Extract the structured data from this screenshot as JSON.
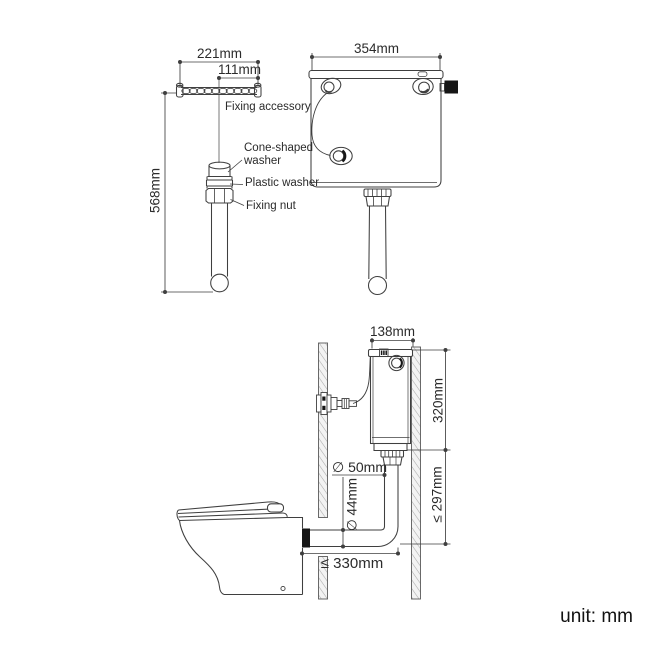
{
  "diagram": {
    "unit_note": "unit: mm",
    "flush_pipe_assembly": {
      "dim_rail_width": "221mm",
      "dim_rail_half_width": "111mm",
      "dim_pipe_length": "568mm",
      "labels": {
        "fixing_accessory": "Fixing accessory",
        "cone_shaped_washer": "Cone-shaped washer",
        "plastic_washer": "Plastic washer",
        "fixing_nut": "Fixing nut"
      }
    },
    "cistern_front_view": {
      "dim_width": "354mm"
    },
    "installation_side_view": {
      "dim_cistern_depth": "138mm",
      "dim_cistern_height": "320mm",
      "dim_drop_max": "≤ 297mm",
      "dim_pipe_upper_diameter": "∅ 50mm",
      "dim_pipe_lower_diameter": "∅ 44mm",
      "dim_offset_max": "≤ 330mm"
    }
  },
  "colors": {
    "background": "#ffffff",
    "line": "#3f3f3f",
    "text": "#2b2b2b",
    "solid_black": "#161616",
    "wall_hatch": "#a8a8a8"
  }
}
